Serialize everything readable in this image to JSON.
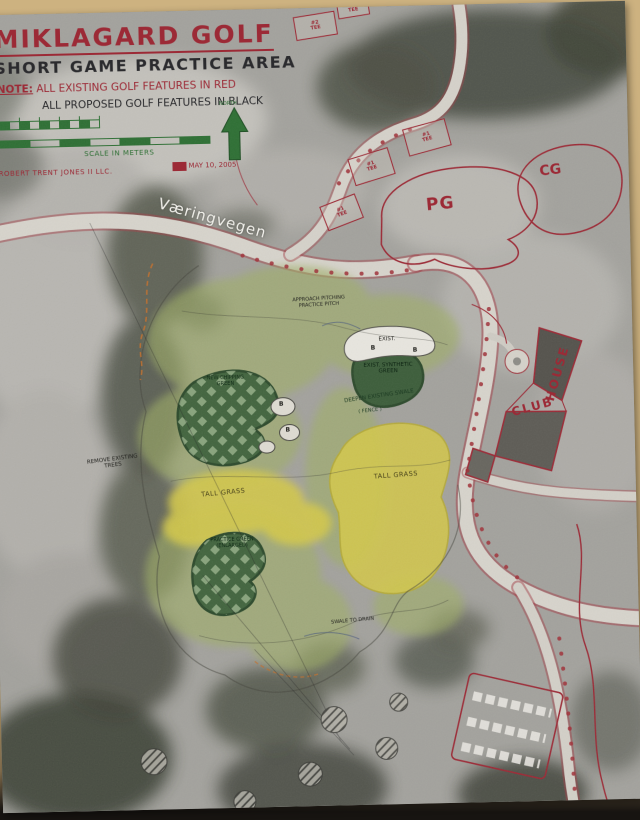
{
  "background": {
    "desk_color": "#cdb280",
    "shadow_color": "#171411"
  },
  "colors": {
    "red_ink": "#9c2a36",
    "black_ink": "#2b2b2e",
    "green_ink": "#2e6f34",
    "green_fill": "#43653f",
    "yellow_fill": "#d2c74c",
    "photo_gray": "#a3a29d"
  },
  "title_block": {
    "title": "MIKLAGARD GOLF",
    "subtitle": "SHORT GAME PRACTICE AREA",
    "note_label": "NOTE:",
    "note_existing": "ALL EXISTING GOLF FEATURES IN RED",
    "note_proposed": "ALL PROPOSED GOLF FEATURES IN BLACK",
    "scale_label": "SCALE IN METERS",
    "firm": "ROBERT TRENT JONES II LLC.",
    "date": "MAY 10, 2005",
    "north_label": "NORTH"
  },
  "map_labels": {
    "road_name": "Væringvegen",
    "practice_green_abbr": "PG",
    "chipping_green_abbr": "CG",
    "club_house_words": [
      "CLUB",
      "HOUSE"
    ],
    "tall_grass_left": "TALL GRASS",
    "tall_grass_right": "TALL GRASS",
    "existing_bunker": "EXIST.",
    "synthetic_green": "EXIST. SYNTHETIC GREEN",
    "green_upper": "NEW CHIPPING GREEN",
    "green_lower": "PRACTICE GREEN (ENLARGED)",
    "swale_note": "DEEPEN EXISTING SWALE",
    "fence_note": "( FENCE )",
    "approach_note": "APPROACH PITCHING PRACTICE PITCH",
    "remove_trees_note": "REMOVE EXISTING TREES",
    "drain_note": "SWALE TO DRAIN"
  },
  "tees": [
    {
      "label": "#2 TEE"
    },
    {
      "label": "#2 TEE"
    },
    {
      "label": "#1 TEE"
    },
    {
      "label": "#1 TEE"
    },
    {
      "label": "#1 TEE"
    }
  ],
  "bunker_marks": [
    "B",
    "B",
    "B",
    "B"
  ]
}
